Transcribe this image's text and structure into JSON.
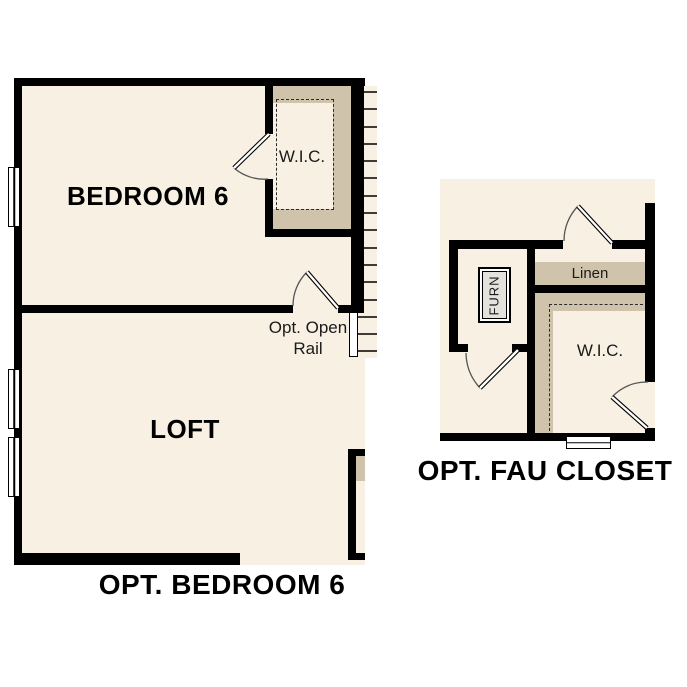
{
  "colors": {
    "floor_fill": "#f7f0e3",
    "closet_fill": "#cfc4ab",
    "wall": "#000000"
  },
  "plan_bedroom6": {
    "caption": "OPT. BEDROOM 6",
    "bedroom_label": "BEDROOM 6",
    "loft_label": "LOFT",
    "wic_label": "W.I.C.",
    "open_rail_note": "Opt. Open Rail"
  },
  "plan_fau_closet": {
    "caption": "OPT. FAU CLOSET",
    "furnace_label": "FURN",
    "linen_label": "Linen",
    "wic_label": "W.I.C."
  }
}
